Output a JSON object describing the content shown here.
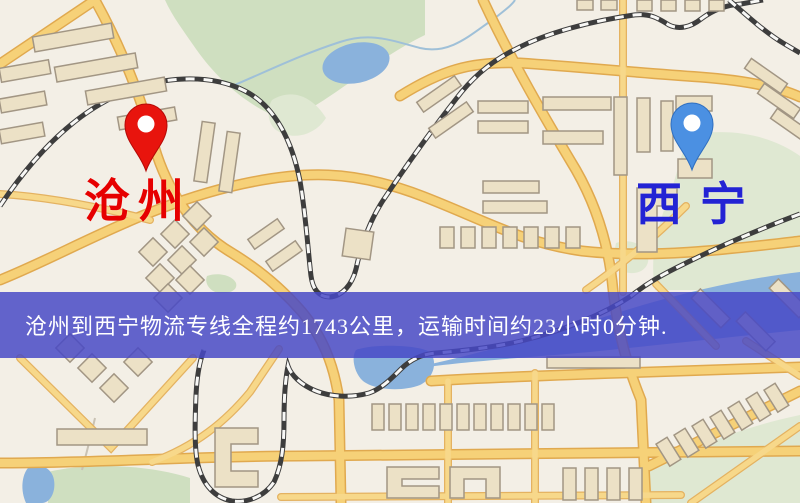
{
  "map": {
    "markers": {
      "origin": {
        "label": "沧州",
        "pin_color": "#e8140d",
        "label_color": "#e60000",
        "pin_style": "red-map-pin"
      },
      "destination": {
        "label": "西宁",
        "pin_color": "#4b90e2",
        "label_color": "#2323d4",
        "pin_style": "blue-map-pin"
      }
    },
    "banner": {
      "text": "沧州到西宁物流专线全程约1743公里，运输时间约23小时0分钟.",
      "background_color": "#4648c6",
      "text_color": "#ffffff",
      "route": {
        "from": "沧州",
        "to": "西宁",
        "distance_text": "约1743公里",
        "duration_text": "约23小时0分钟"
      }
    }
  },
  "colors": {
    "map_background": "#f3efe6",
    "road_fill": "#f6d178",
    "road_casing": "#e0a94f",
    "building": "#ece1c6",
    "green_area": "#cfdfc0",
    "water": "#8ab2dc",
    "railway": "#3d3d3d"
  }
}
